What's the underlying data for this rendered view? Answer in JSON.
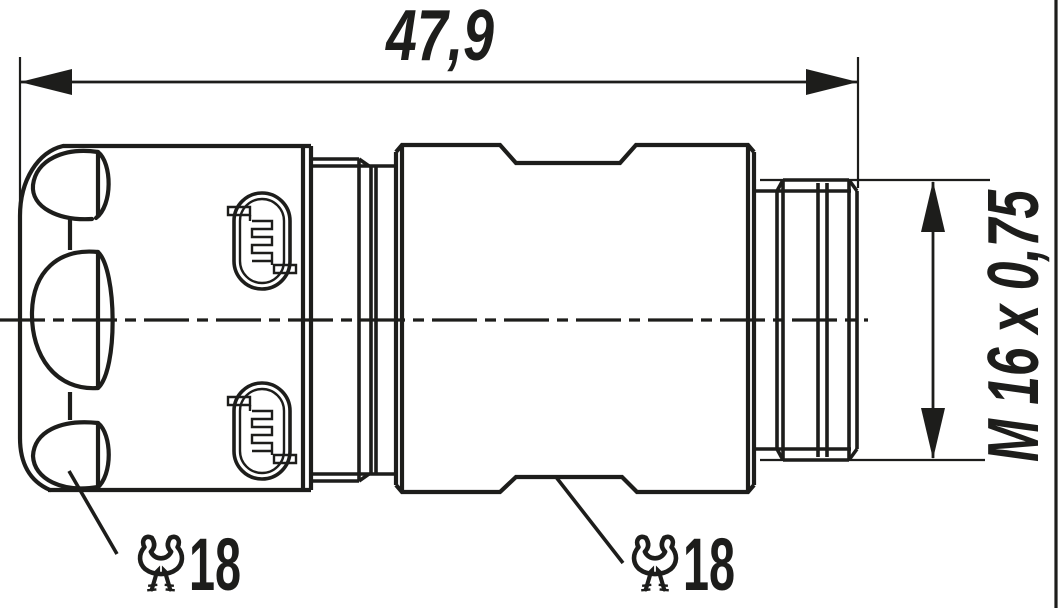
{
  "page": {
    "background_color": "#ffffff",
    "line_color": "#1d1d1b",
    "type": "technical-drawing-connector-side-view"
  },
  "dimensions": {
    "overall_length": "47,9",
    "thread_spec": "M 16 x 0,75"
  },
  "wrench_labels": {
    "left": {
      "icon": "wrench-icon",
      "size": "18"
    },
    "right": {
      "icon": "wrench-icon",
      "size": "18"
    }
  }
}
